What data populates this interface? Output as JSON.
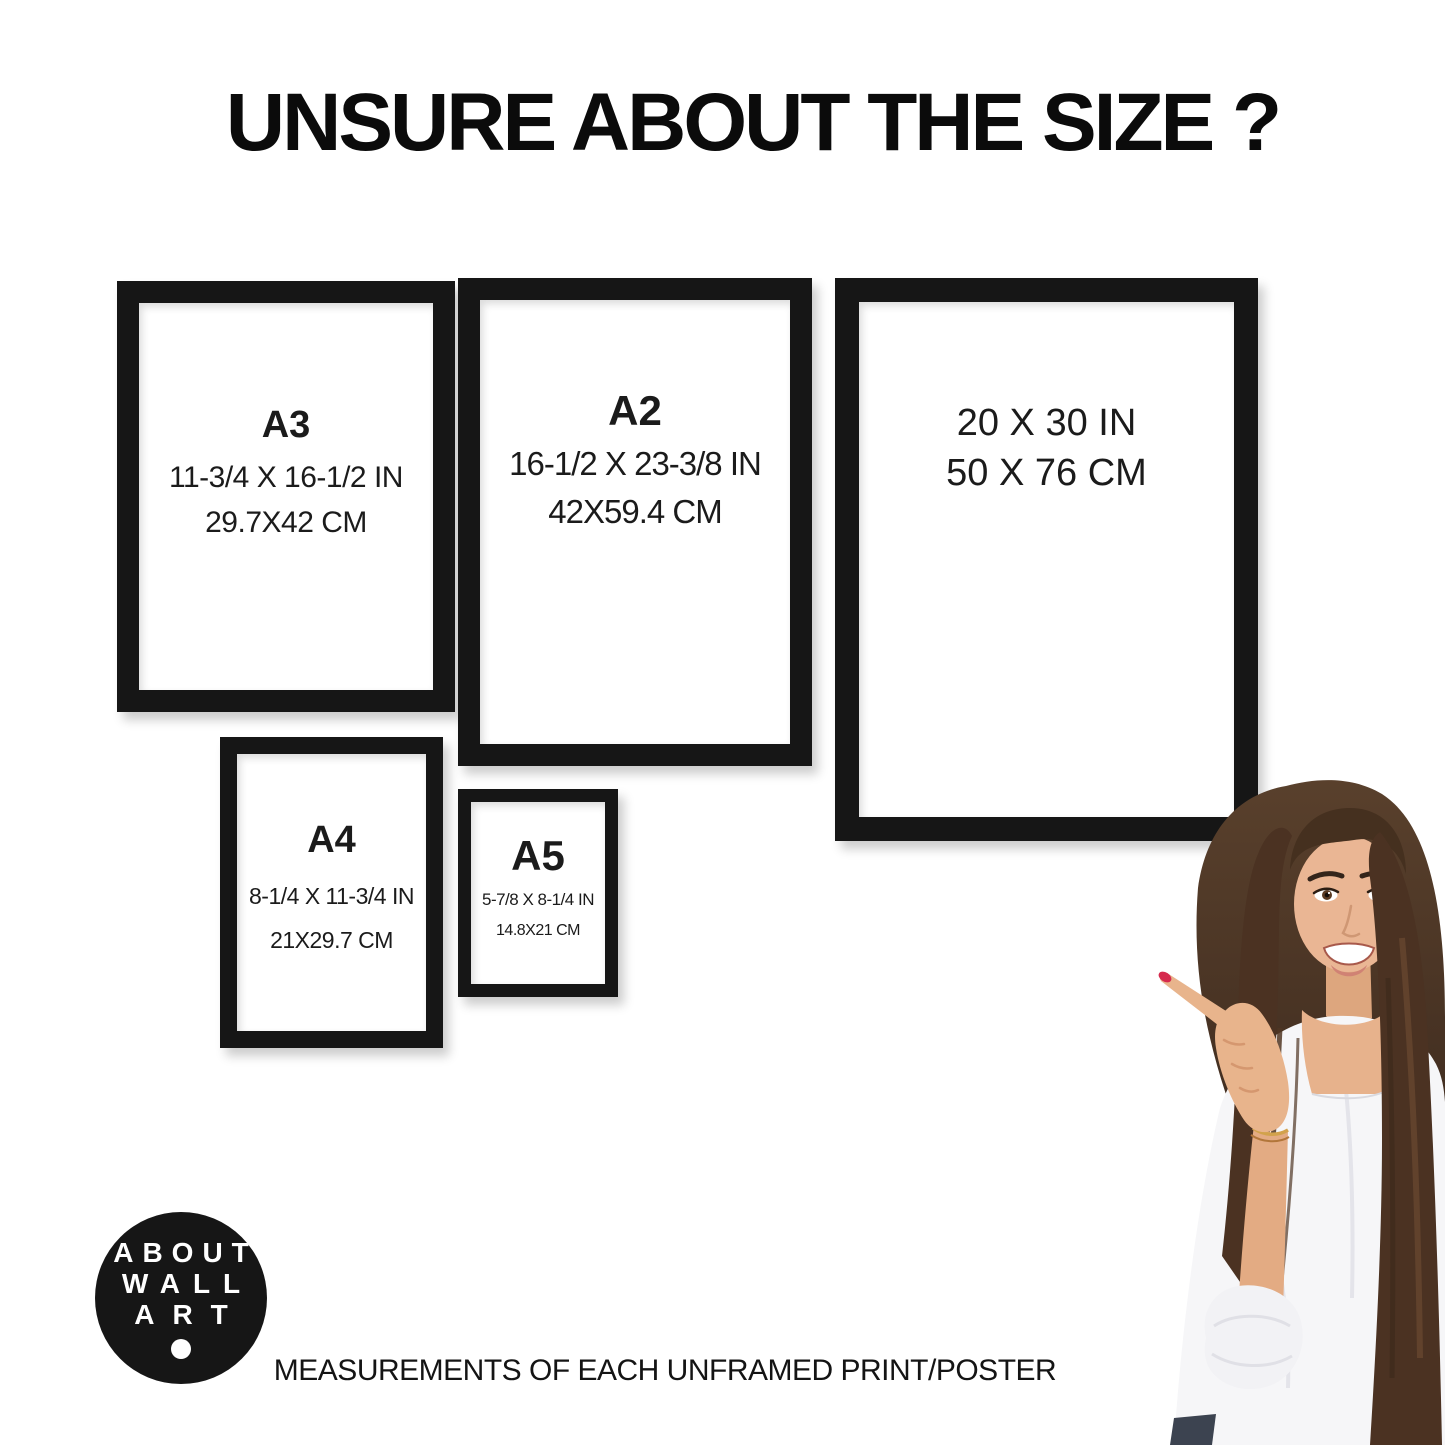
{
  "page": {
    "title": "UNSURE ABOUT THE SIZE ?",
    "footer_note": "MEASUREMENTS OF EACH UNFRAMED PRINT/POSTER"
  },
  "colors": {
    "background": "#ffffff",
    "frame": "#161616",
    "text": "#121212",
    "logo_bg": "#161616",
    "logo_text": "#ffffff"
  },
  "frames": [
    {
      "id": "a3",
      "label": "A3",
      "inches": "11-3/4 X 16-1/2 IN",
      "cm": "29.7X42 CM"
    },
    {
      "id": "a2",
      "label": "A2",
      "inches": "16-1/2 X 23-3/8 IN",
      "cm": "42X59.4 CM"
    },
    {
      "id": "20x30",
      "inches": "20 X 30 IN",
      "cm": "50 X 76 CM"
    },
    {
      "id": "a4",
      "label": "A4",
      "inches": "8-1/4 X 11-3/4 IN",
      "cm": "21X29.7 CM"
    },
    {
      "id": "a5",
      "label": "A5",
      "inches": "5-7/8 X 8-1/4 IN",
      "cm": "14.8X21 CM"
    }
  ],
  "logo": {
    "line1": "ABOUT",
    "line2": "WALL",
    "line3": "ART"
  },
  "illustration": {
    "subject": "woman-pointing-at-frames",
    "hair_color": "#4b3222",
    "skin_color": "#e8b48c",
    "top_color": "#f6f6f8",
    "nail_color": "#d62a4e"
  }
}
